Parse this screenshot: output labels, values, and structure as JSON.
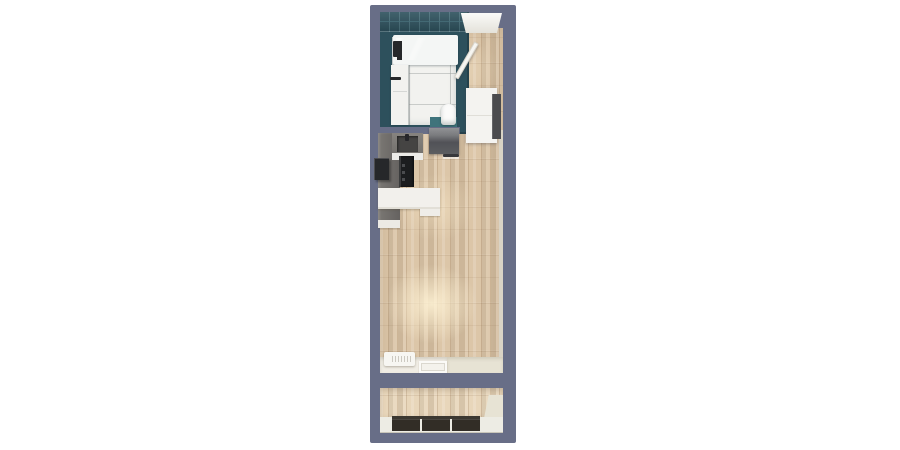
{
  "scene": {
    "type": "floor-plan",
    "view": "top-down 3d render",
    "unit": "studio apartment with bathroom, kitchenette, living area and balcony",
    "background": "#ffffff"
  },
  "colors": {
    "wall": "#686e87",
    "innerFace": "#d9d3c5",
    "wood": "#dcc6a8",
    "woodLight": "#e8d6ba",
    "tile": "#2d505c",
    "tileGrout": "#476e79",
    "tileMat": "#3f737b",
    "water": "#cfe3df",
    "fixtureWhite": "#f2f2ef",
    "counterGray": "#6e6b67",
    "cabinetGray": "#55565a",
    "applianceBlack": "#26272a",
    "sinkBasin": "#454443",
    "cream": "#e7e3d4",
    "glassDark": "#322d26",
    "frameDark": "#3c3831",
    "metalDark": "#26282a",
    "panelDark": "#4b4b4e",
    "highlight": "#fff3d9"
  },
  "rooms": [
    {
      "id": "bathroom",
      "fixtures": [
        "bathtub",
        "bath-faucet",
        "bathroom-cabinet",
        "toilet",
        "bath-mat",
        "tiled-walls",
        "tiled-floor"
      ]
    },
    {
      "id": "entry-hall",
      "fixtures": [
        "entry-door",
        "wardrobe"
      ]
    },
    {
      "id": "kitchenette",
      "fixtures": [
        "wall-cabinets",
        "sink",
        "cooktop",
        "wall-oven",
        "counter"
      ]
    },
    {
      "id": "living-area",
      "fixtures": [
        "radiator",
        "window-sill",
        "balcony-door-step"
      ]
    },
    {
      "id": "balcony",
      "fixtures": [
        "glass-railing",
        "decking"
      ]
    }
  ]
}
